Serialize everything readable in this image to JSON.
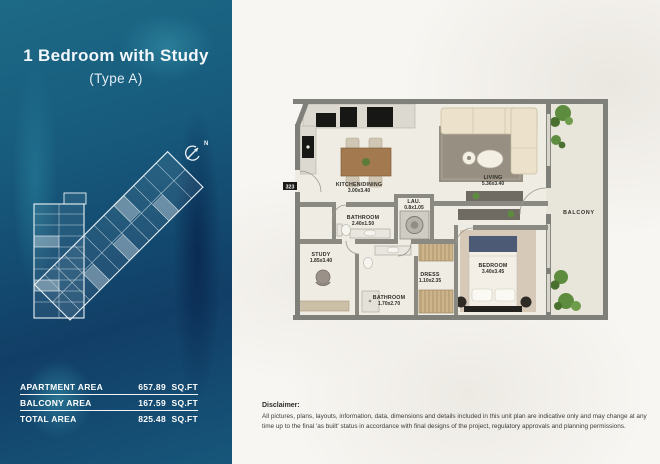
{
  "sidebar": {
    "title": "1 Bedroom with Study",
    "subtitle": "(Type A)",
    "north_label": "N",
    "area_table": {
      "rows": [
        {
          "label": "APARTMENT AREA",
          "value": "657.89",
          "unit": "SQ.FT"
        },
        {
          "label": "BALCONY AREA",
          "value": "167.59",
          "unit": "SQ.FT"
        },
        {
          "label": "TOTAL AREA",
          "value": "825.48",
          "unit": "SQ.FT"
        }
      ]
    }
  },
  "floorplan": {
    "unit_number": "323",
    "rooms": [
      {
        "name": "KITCHEN/DINING",
        "dims": "3.00x3.40"
      },
      {
        "name": "LIVING",
        "dims": "5.36x3.40"
      },
      {
        "name": "BATHROOM",
        "dims": "2.40x1.50"
      },
      {
        "name": "LAU.",
        "dims": "0.8x1.05"
      },
      {
        "name": "STUDY",
        "dims": "1.85x3.40"
      },
      {
        "name": "DRESS",
        "dims": "1.10x2.35"
      },
      {
        "name": "BATHROOM",
        "dims": "1.70x2.70"
      },
      {
        "name": "BEDROOM",
        "dims": "3.40x3.45"
      },
      {
        "name": "BALCONY",
        "dims": ""
      }
    ]
  },
  "disclaimer": {
    "heading": "Disclaimer:",
    "text": "All pictures, plans, layouts, information, data, dimensions and details included in this unit plan are indicative only and may change at any time up to the final 'as built' status in accordance with final designs of the project, regulatory approvals and planning permissions."
  },
  "colors": {
    "sidebar_deep": "#113e66",
    "sidebar_teal": "#1d6a86",
    "wall_gray": "#80807a",
    "floor_cream": "#efece3",
    "plant_green": "#5e8c3e"
  }
}
